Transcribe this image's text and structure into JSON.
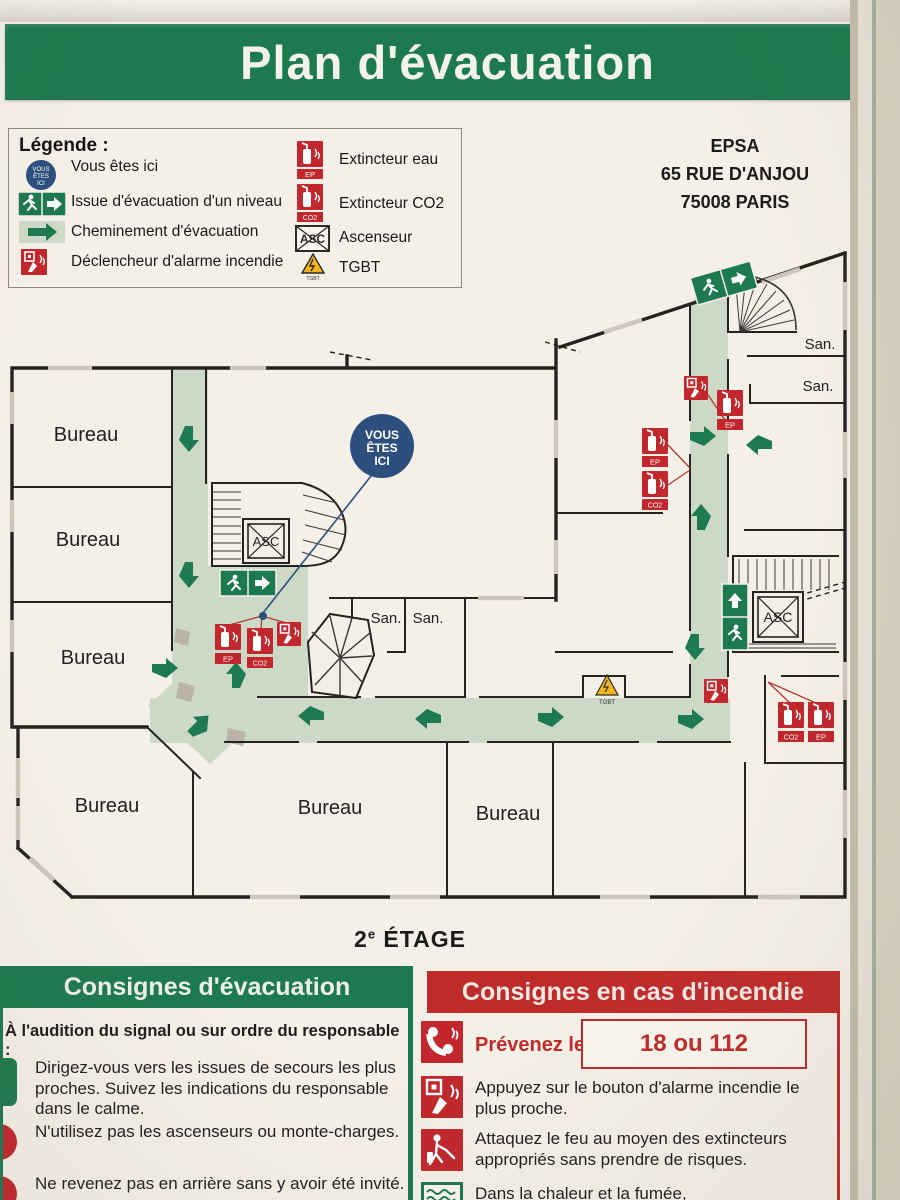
{
  "title": "Plan d'évacuation",
  "address": {
    "line1": "EPSA",
    "line2": "65 RUE D'ANJOU",
    "line3": "75008 PARIS"
  },
  "legend": {
    "heading": "Légende :",
    "items_left": [
      {
        "icon": "you-are-here-icon",
        "label": "Vous êtes ici"
      },
      {
        "icon": "exit-sign-icon",
        "label": "Issue d'évacuation d'un niveau"
      },
      {
        "icon": "evacuation-path-arrow-icon",
        "label": "Cheminement d'évacuation"
      },
      {
        "icon": "fire-alarm-icon",
        "label": "Déclencheur d'alarme incendie"
      }
    ],
    "items_right": [
      {
        "icon": "extinguisher-water-icon",
        "label": "Extincteur eau"
      },
      {
        "icon": "extinguisher-co2-icon",
        "label": "Extincteur CO2"
      },
      {
        "icon": "elevator-icon",
        "label": "Ascenseur"
      },
      {
        "icon": "tgbt-icon",
        "label": "TGBT"
      }
    ]
  },
  "plan": {
    "you_are_here": {
      "l1": "VOUS",
      "l2": "ÊTES",
      "l3": "ICI"
    },
    "labels": {
      "bureau": "Bureau",
      "san": "San.",
      "asc": "ASC",
      "tgbt": "TGBT",
      "ep": "EP",
      "co2": "CO2"
    }
  },
  "floor": {
    "number": "2",
    "exponent": "e",
    "text": " ÉTAGE"
  },
  "instructions_evacuation": {
    "heading": "Consignes d'évacuation",
    "intro": "À l'audition du signal ou sur ordre du responsable :",
    "items": [
      "Dirigez-vous vers les issues de secours les plus proches. Suivez les indications du responsable dans le calme.",
      "N'utilisez pas les ascenseurs ou monte-charges.",
      "Ne revenez pas en arrière sans y avoir été invité."
    ]
  },
  "instructions_fire": {
    "heading": "Consignes en cas d'incendie",
    "call_label": "Prévenez le :",
    "call_numbers": "18 ou 112",
    "items": [
      "Appuyez sur le bouton d'alarme incendie le plus proche.",
      "Attaquez le feu au moyen des extincteurs appropriés sans prendre de risques.",
      "Dans la chaleur et la fumée,"
    ]
  },
  "colors": {
    "green": "#1d7a4e",
    "red_header": "#bf2b2b",
    "icon_red": "#c1272d",
    "blue": "#2c4f7e",
    "corridor_green": "#ccd9c6",
    "warning_yellow": "#f0b51f"
  }
}
